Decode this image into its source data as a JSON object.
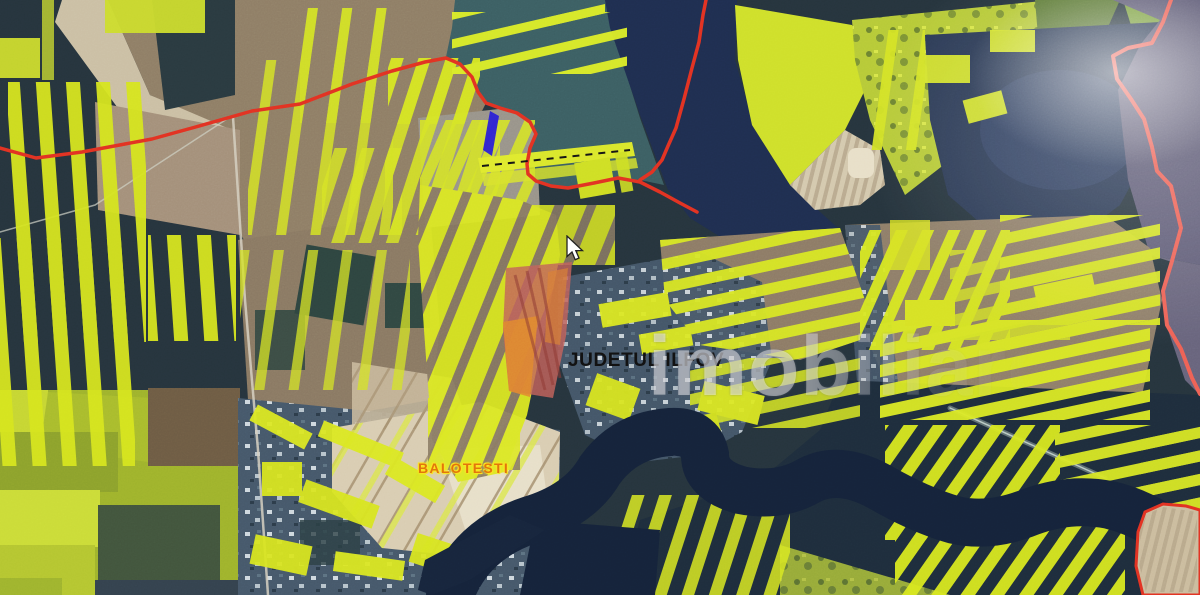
{
  "labels": {
    "county": "JUDETUL ILFOV",
    "town": "BALOTESTI"
  },
  "watermark": {
    "text": "imobiliare"
  },
  "cursor": {
    "icon": "arrow-pointer",
    "visible": true
  },
  "colors": {
    "boundary_red": "#e23222",
    "boundary_pink": "#ee6155",
    "parcel_yellow": "#d9e822",
    "selected_parcel_blue": "#2a1fd6",
    "highlight_parcel_red": "#c2625a",
    "highlight_parcel_orange": "#e1892f",
    "county_label_black": "#121212",
    "town_label_orange": "#e2760c",
    "water_dark": "#15233a"
  }
}
